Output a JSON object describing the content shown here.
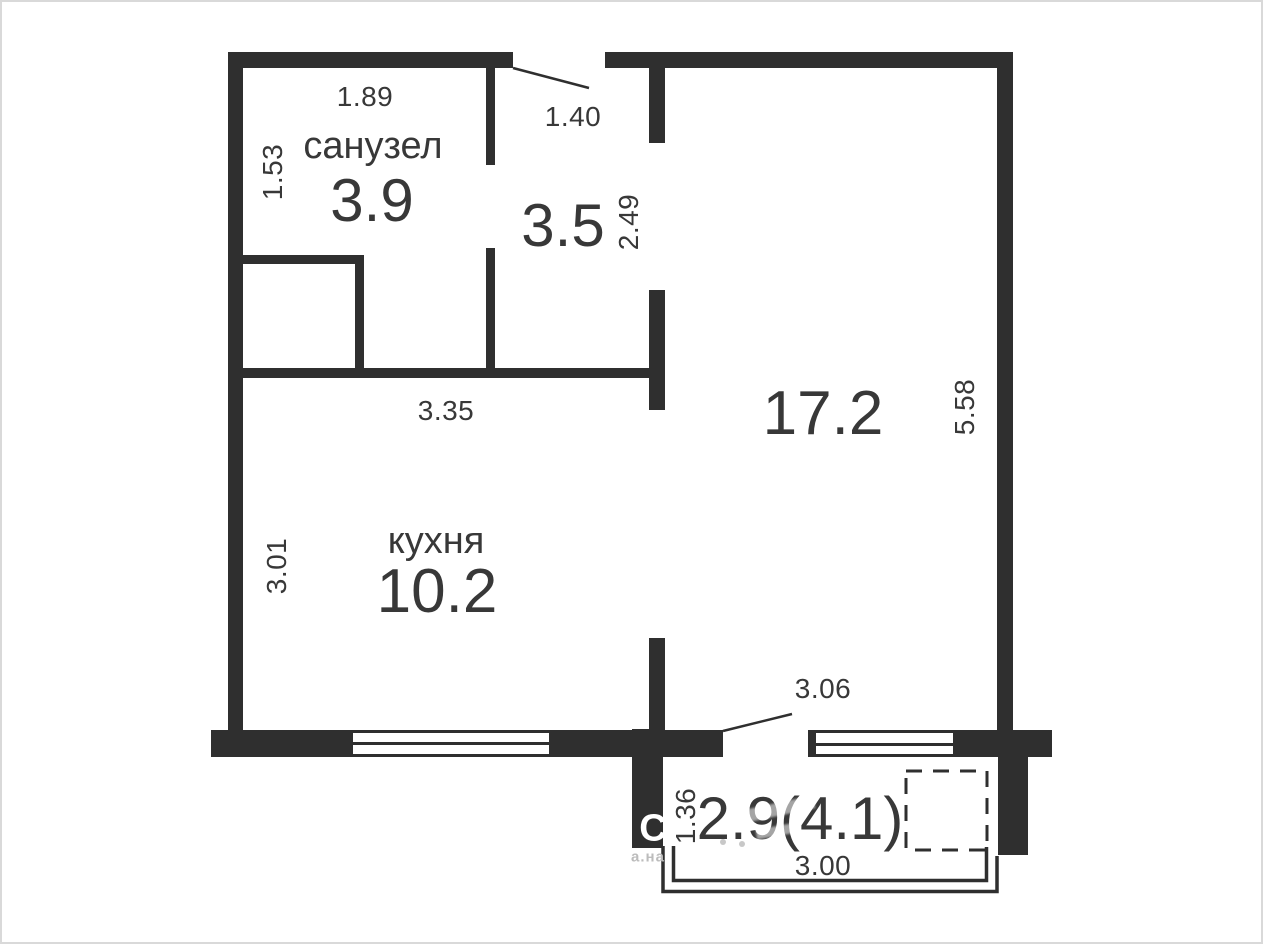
{
  "floor_plan": {
    "rooms": [
      {
        "key": "bathroom",
        "label": "санузел",
        "area": "3.9"
      },
      {
        "key": "hallway",
        "label": "",
        "area": "3.5"
      },
      {
        "key": "living_room",
        "label": "",
        "area": "17.2"
      },
      {
        "key": "kitchen",
        "label": "кухня",
        "area": "10.2"
      },
      {
        "key": "balcony",
        "label": "",
        "area": "2.9(4.1)"
      }
    ],
    "dimensions": {
      "bathroom_width": "1.89",
      "bathroom_depth": "1.53",
      "entry_opening": "1.40",
      "hallway_depth": "2.49",
      "hallway_width": "3.35",
      "living_depth": "5.58",
      "kitchen_depth": "3.01",
      "living_width": "3.06",
      "balcony_depth": "1.36",
      "balcony_width": "3.00"
    },
    "watermark": {
      "initial": "C",
      "fragment": "а.на"
    },
    "colors": {
      "wall": "#2f2f2f",
      "text": "#383838",
      "background": "#ffffff",
      "frame": "#d9d9d9"
    }
  }
}
